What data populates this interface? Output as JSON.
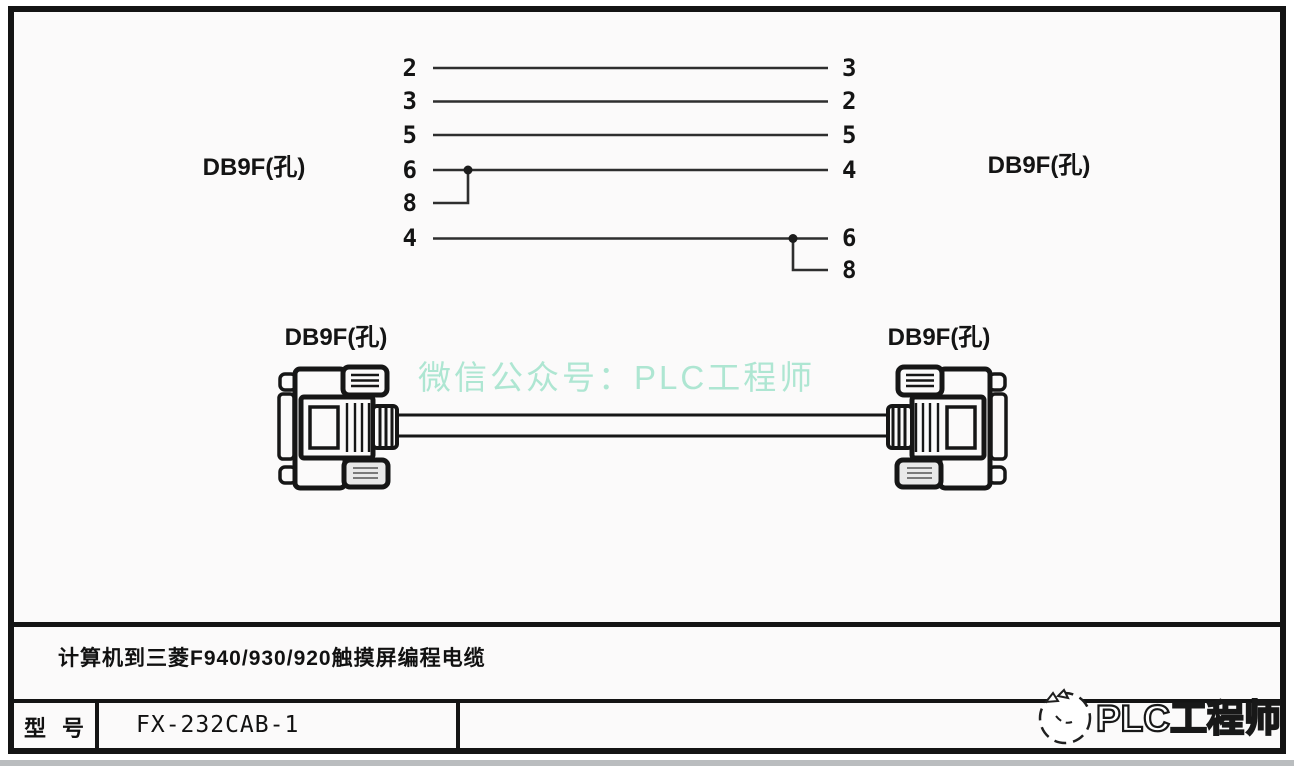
{
  "pins": {
    "left": [
      "2",
      "3",
      "5",
      "6",
      "8",
      "4"
    ],
    "right": [
      "3",
      "2",
      "5",
      "4",
      "6",
      "8"
    ]
  },
  "connections": [
    {
      "left": "2",
      "right": "3"
    },
    {
      "left": "3",
      "right": "2"
    },
    {
      "left": "5",
      "right": "5"
    },
    {
      "left": "6+8",
      "right": "4"
    },
    {
      "left": "4",
      "right": "6+8"
    }
  ],
  "labels": {
    "top_left": "DB9F(孔)",
    "top_right": "DB9F(孔)",
    "mid_left": "DB9F(孔)",
    "mid_right": "DB9F(孔)"
  },
  "watermark": {
    "center_text": "微信公众号：PLC工程师",
    "corner_text": "PLC工程师",
    "center_color": "#aee6d2"
  },
  "title_block": {
    "description": "计算机到三菱F940/930/920触摸屏编程电缆",
    "model_label": "型 号",
    "model_value": "FX-232CAB-1"
  },
  "colors": {
    "frame": "#141414",
    "wire": "#2e2e2e",
    "paper": "#fbfafa"
  }
}
